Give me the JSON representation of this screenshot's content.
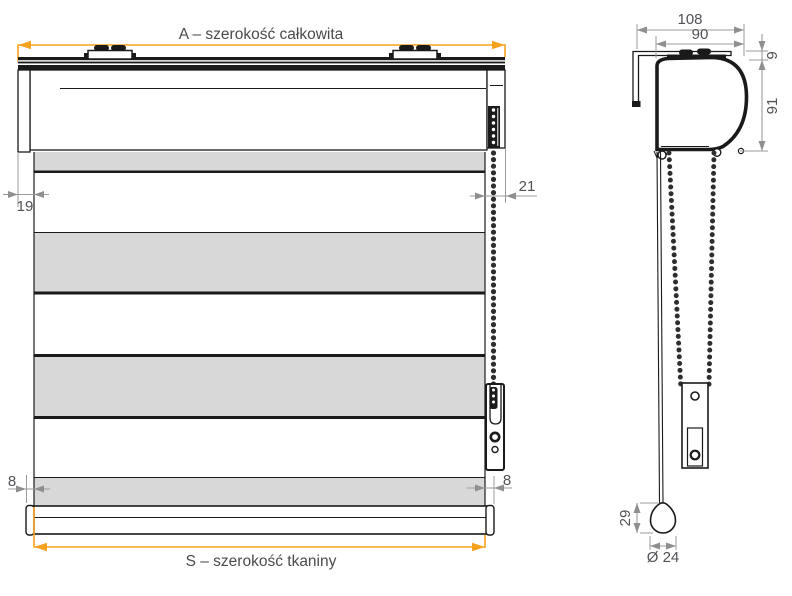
{
  "colors": {
    "accent_orange": "#F6A21D",
    "dim_line_gray": "#9b9b9b",
    "dim_text_gray": "#515156",
    "drawing_black": "#1a1a1a",
    "fabric_gray": "#d8d8d8"
  },
  "front_view": {
    "dim_total_width_label": "A – szerokość całkowita",
    "dim_fabric_width_label": "S – szerokość tkaniny",
    "dim_left_bracket_offset": "19",
    "dim_chain_side_offset": "21",
    "dim_bottom_bar_left_overhang": "8",
    "dim_bottom_bar_right_overhang": "8"
  },
  "side_view": {
    "dim_total_depth": "108",
    "dim_cassette_width": "90",
    "dim_clip_height": "9",
    "dim_cassette_height": "91",
    "dim_chain_weight_height": "29",
    "dim_chain_weight_diameter": "Ø 24"
  }
}
